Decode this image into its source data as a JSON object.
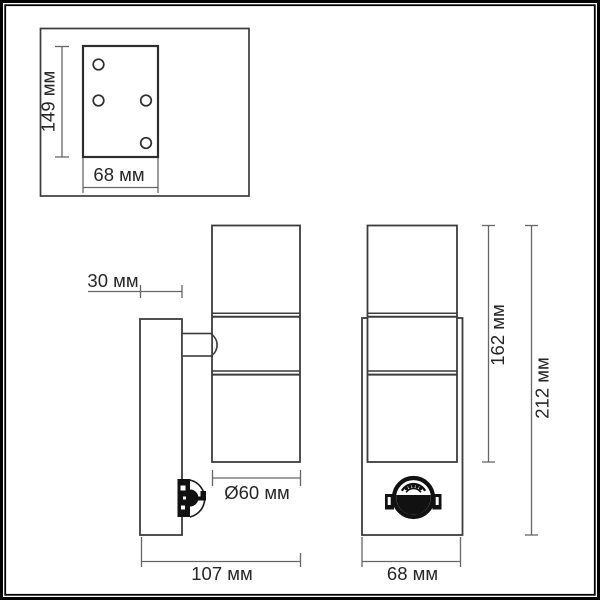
{
  "drawing": {
    "type": "technical-dimension-drawing",
    "subject": "wall-mounted cylindrical up/down lamp with PIR motion sensor",
    "colors": {
      "background": "#ffffff",
      "frame": "#000000",
      "outline": "#3c3c3c",
      "dimension_line": "#666666",
      "text": "#262626",
      "sensor": "#111111"
    }
  },
  "mounting_plate_inset": {
    "height_label": "149 мм",
    "width_label": "68 мм",
    "hole_count": 4
  },
  "side_view": {
    "plate_depth_label": "30 мм",
    "diameter_label": "Ø60 мм",
    "total_depth_label": "107 мм"
  },
  "front_view": {
    "body_height_label": "162 мм",
    "total_height_label": "212 мм",
    "width_label": "68 мм"
  }
}
